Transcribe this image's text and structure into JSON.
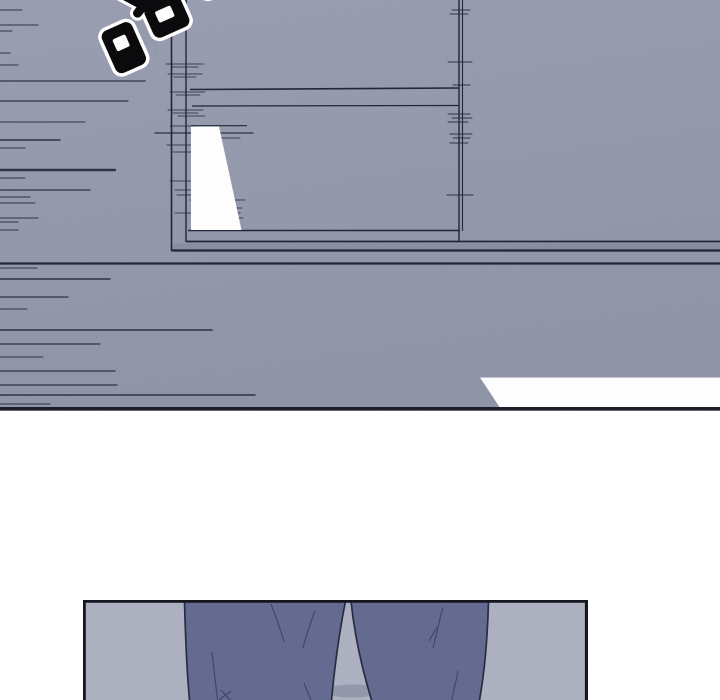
{
  "page": {
    "background": "#ffffff"
  },
  "sfx": {
    "text": "喀",
    "fill": "#0b0b0d",
    "outline": "#ffffff"
  },
  "panels": {
    "top": {
      "background": "#9a9fb1",
      "background_bottom": "#9095a8",
      "line_color": "#23253a",
      "highlight": "#fdfdfe",
      "border_bottom_color": "#1c1e2a"
    },
    "bottom": {
      "background": "#aeb2c1",
      "border_color": "#15161f",
      "pants_fill": "#656b90",
      "pants_outline": "#262940",
      "crease_color": "#3a3e58",
      "shadow_color": "#3c415e"
    }
  }
}
